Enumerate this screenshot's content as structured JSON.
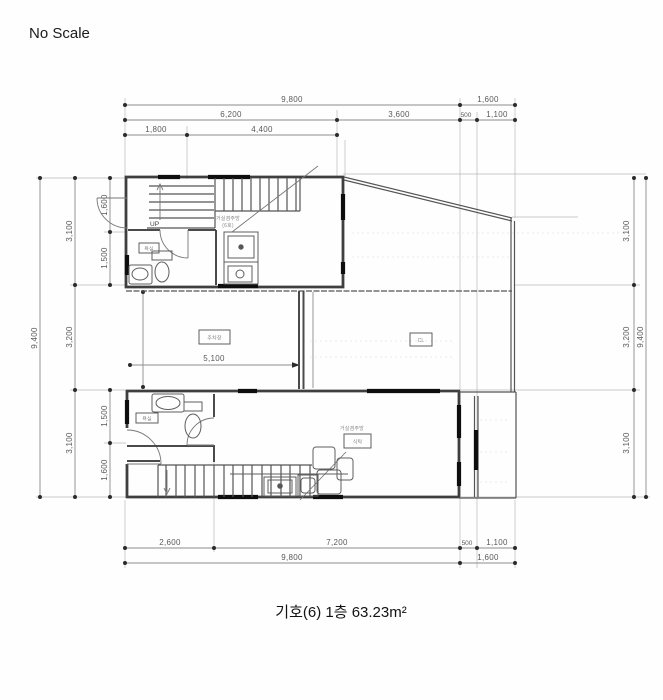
{
  "page": {
    "note": "No Scale",
    "caption": "기호(6) 1층 63.23m²"
  },
  "dims": {
    "top": [
      "9,800",
      "1,600",
      "6,200",
      "3,600",
      "500",
      "1,100",
      "1,800",
      "4,400"
    ],
    "bottom": [
      "2,600",
      "7,200",
      "500",
      "1,100",
      "9,800",
      "1,600"
    ],
    "left": [
      "9,400",
      "3,100",
      "3,200",
      "3,100",
      "1,600",
      "1,500",
      "1,500",
      "1,600"
    ],
    "right": [
      "3,100",
      "3,200",
      "3,100",
      "9,400"
    ],
    "interior": "5,100"
  },
  "labels": {
    "up": "UP",
    "unit_top_line1": "거실겸주방",
    "unit_top_line2": "(6호)",
    "parking": "주차장",
    "closet": "CL",
    "bath_top": "욕실",
    "bath_bottom": "욕실",
    "living": "거실겸주방",
    "table": "식탁"
  }
}
